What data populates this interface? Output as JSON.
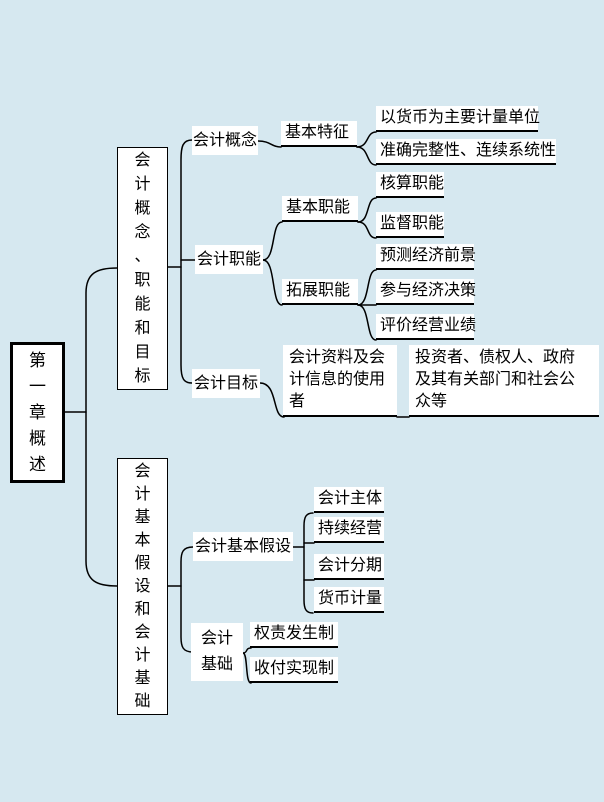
{
  "canvas": {
    "background_color": "#d6e8f0",
    "node_background": "#ffffff",
    "line_color": "#000000"
  },
  "mindmap": {
    "root": {
      "label": "第一章概述"
    },
    "branches": [
      {
        "label": "会计概念、职能和目标",
        "children": [
          {
            "label": "会计概念",
            "children": [
              {
                "label": "基本特征",
                "children": [
                  {
                    "label": "以货币为主要计量单位"
                  },
                  {
                    "label": "准确完整性、连续系统性"
                  }
                ]
              }
            ]
          },
          {
            "label": "会计职能",
            "children": [
              {
                "label": "基本职能",
                "children": [
                  {
                    "label": "核算职能"
                  },
                  {
                    "label": "监督职能"
                  }
                ]
              },
              {
                "label": "拓展职能",
                "children": [
                  {
                    "label": "预测经济前景"
                  },
                  {
                    "label": "参与经济决策"
                  },
                  {
                    "label": "评价经营业绩"
                  }
                ]
              }
            ]
          },
          {
            "label": "会计目标",
            "children": [
              {
                "label": "会计资料及会计信息的使用者",
                "lines": [
                  "会计资料及会",
                  "计信息的使用",
                  "者"
                ],
                "children": [
                  {
                    "label": "投资者、债权人、政府及其有关部门和社会公众等",
                    "lines": [
                      "投资者、债权人、政府",
                      "及其有关部门和社会公",
                      "众等"
                    ]
                  }
                ]
              }
            ]
          }
        ]
      },
      {
        "label": "会计基本假设和会计基础",
        "children": [
          {
            "label": "会计基本假设",
            "children": [
              {
                "label": "会计主体"
              },
              {
                "label": "持续经营"
              },
              {
                "label": "会计分期"
              },
              {
                "label": "货币计量"
              }
            ]
          },
          {
            "label": "会计基础",
            "lines": [
              "会计",
              "基础"
            ],
            "children": [
              {
                "label": "权责发生制"
              },
              {
                "label": "收付实现制"
              }
            ]
          }
        ]
      }
    ]
  }
}
